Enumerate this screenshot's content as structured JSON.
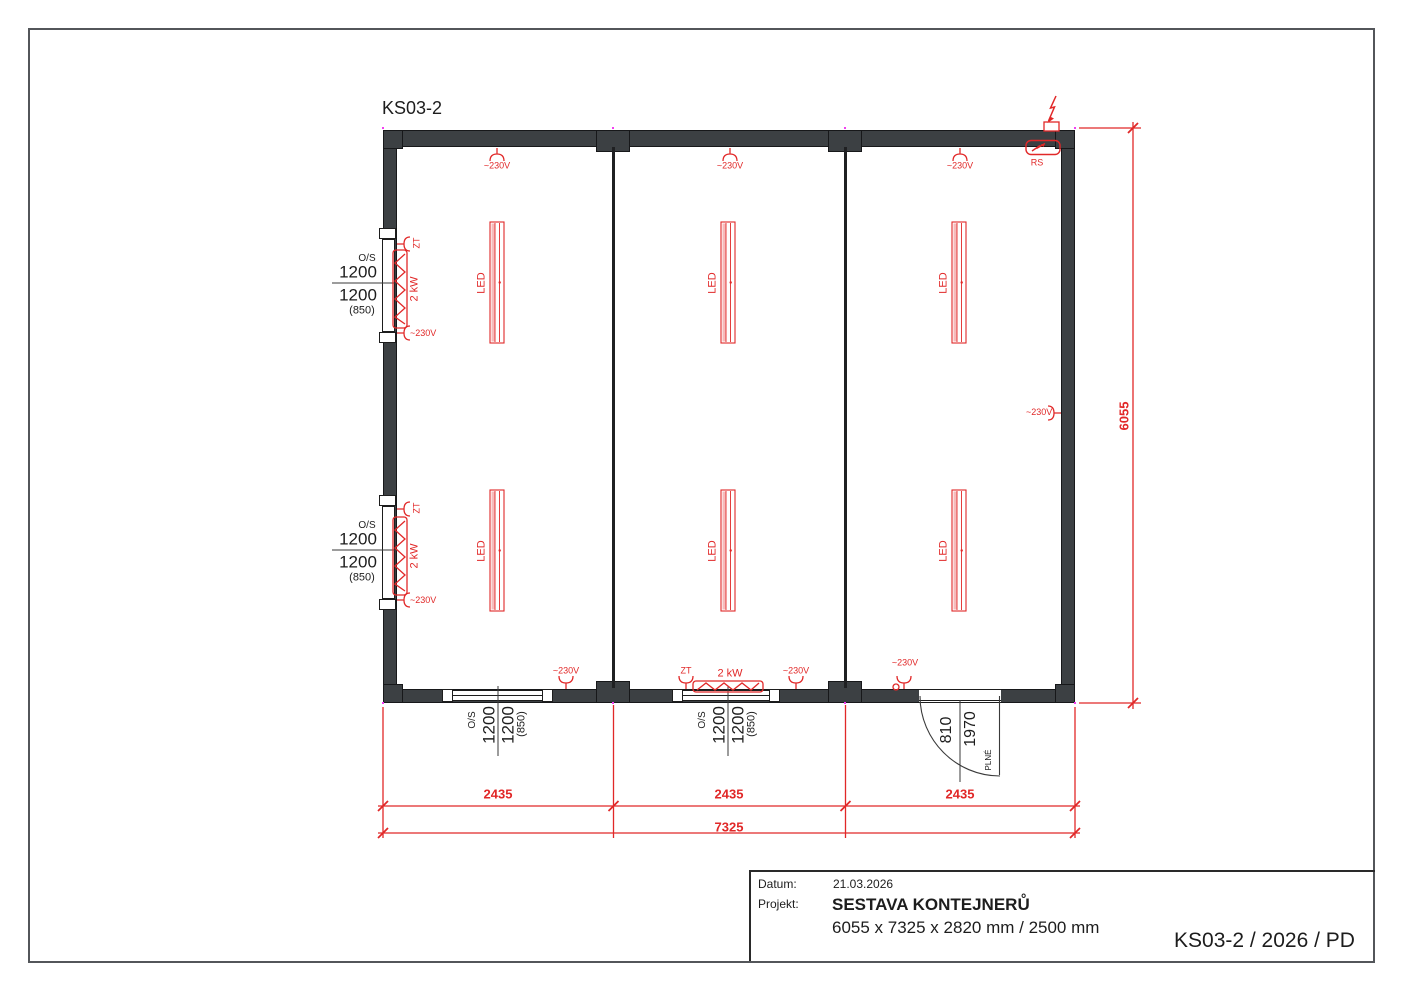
{
  "drawing": {
    "title": "KS03-2",
    "doc_code": "KS03-2 / 2026 / PD"
  },
  "title_block": {
    "date_label": "Datum:",
    "date_value": "21.03.2026",
    "project_label": "Projekt:",
    "project_name": "SESTAVA KONTEJNERŮ",
    "project_size": "6055 x 7325 x 2820 mm / 2500 mm"
  },
  "dimensions": {
    "segments": [
      "2435",
      "2435",
      "2435"
    ],
    "total_width": "7325",
    "total_depth": "6055"
  },
  "window": {
    "type": "O/S",
    "width": "1200",
    "height": "1200",
    "parapet": "(850)"
  },
  "door": {
    "width": "810",
    "height": "1970",
    "type": "PLNÉ"
  },
  "electrical": {
    "socket": "~230V",
    "heater_socket": "ZT",
    "heater_power": "2 kW",
    "light": "LED",
    "switchboard": "RS"
  },
  "colors": {
    "accent": "#e12828",
    "wall": "#3c4043"
  }
}
